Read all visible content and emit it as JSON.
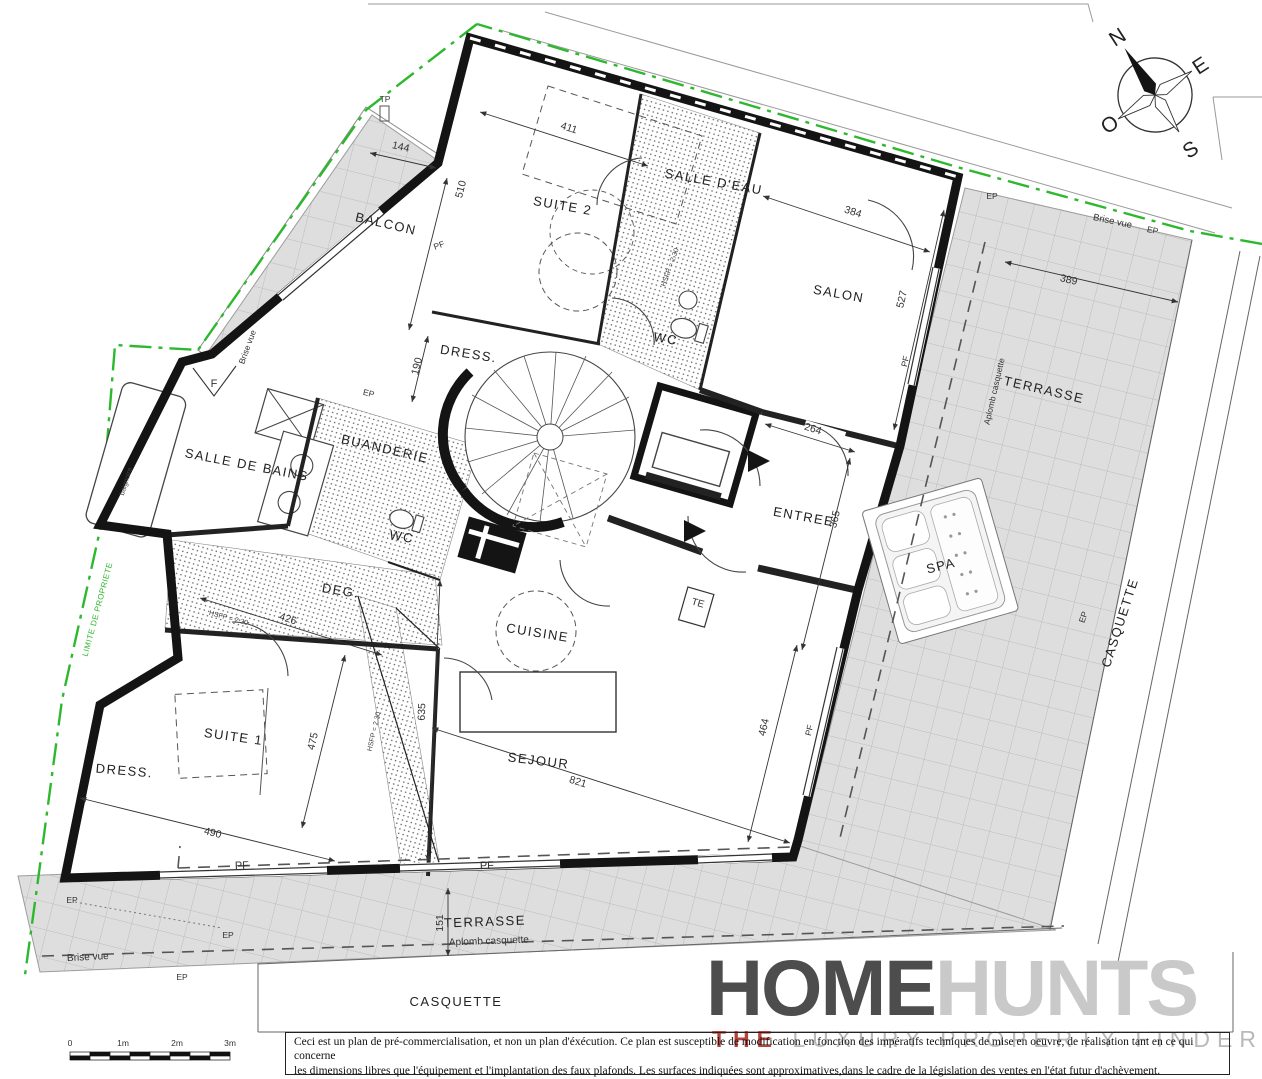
{
  "rooms": {
    "balcon": "BALCON",
    "suite2": "SUITE 2",
    "salle_deau": "SALLE D'EAU",
    "salon": "SALON",
    "dress_top": "DRESS.",
    "wc_top": "WC",
    "entree": "ENTREE",
    "salle_de_bains": "SALLE DE BAINS",
    "buanderie": "BUANDERIE",
    "wc_mid": "WC",
    "deg": "DEG.",
    "suite1": "SUITE 1",
    "dress_bottom": "DRESS.",
    "cuisine": "CUISINE",
    "sejour": "SEJOUR",
    "terrasse": "TERRASSE",
    "spa": "SPA",
    "casquette": "CASQUETTE"
  },
  "dimensions": {
    "d144": "144",
    "d411": "411",
    "d510": "510",
    "d190": "190",
    "d384": "384",
    "d527": "527",
    "d389": "389",
    "d264": "264",
    "d365": "365",
    "d426": "426",
    "d475": "475",
    "d490": "490",
    "d635": "635",
    "d821": "821",
    "d464": "464",
    "d151": "151"
  },
  "annotations": {
    "tp": "TP",
    "pf": "PF",
    "ep": "EP",
    "f": "F",
    "te": "TE",
    "brise_vue": "Brise vue",
    "aplomb_casquette": "Aplomb casquette",
    "limite_propriete": "LIMITE DE PROPRIETE",
    "hsfp": "HSFP = 2.30",
    "baignoire": "baignoire"
  },
  "compass": {
    "n": "N",
    "e": "E",
    "s": "S",
    "o": "O"
  },
  "scale_bar": {
    "t0": "0",
    "t1": "1m",
    "t2": "2m",
    "t3": "3m"
  },
  "logo": {
    "home": "HOME",
    "hunts": "HUNTS",
    "tagline_the": "THE",
    "tagline_rest": " LUXURY PROPERTY FINDERS"
  },
  "disclaimer": {
    "line1": "Ceci est un plan de pré-commercialisation, et non un plan d'éxécution. Ce plan est susceptible de modification en fonction des impératifs techniques de mise en oeuvre, de réalisation tant en ce qui concerne",
    "line2": "les dimensions libres que l'équipement et l'implantation des faux plafonds. Les surfaces indiquées sont approximatives,dans le cadre de la législation des ventes en l'état futur d'achèvement.",
    "line3": "Les retombées de poutre, soffites, faux-plafonds, canalisations et convecteurs ne sont pas toujours représentés."
  },
  "colors": {
    "boundary_green": "#2eb82e",
    "wall_black": "#141414",
    "terrace_gray": "#dedede",
    "logo_dark": "#4d4d4d",
    "logo_light": "#c9c9c9",
    "logo_red": "#b8413a"
  }
}
